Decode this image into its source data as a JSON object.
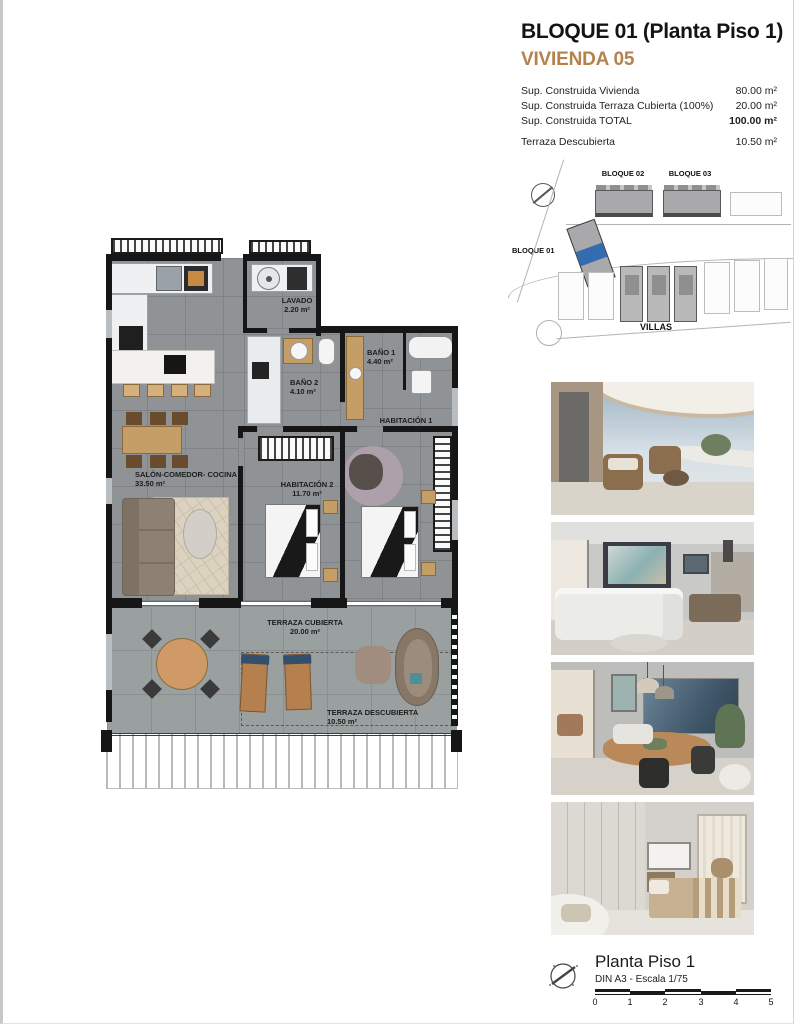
{
  "header": {
    "title": "BLOQUE 01  (Planta Piso 1)",
    "subtitle": "VIVIENDA 05",
    "areas": [
      {
        "label": "Sup. Construida Vivienda",
        "value": "80.00 m²"
      },
      {
        "label": "Sup. Construida Terraza Cubierta (100%)",
        "value": "20.00 m²"
      },
      {
        "label": "Sup. Construida TOTAL",
        "value": "100.00 m²"
      },
      {
        "label": "Terraza Descubierta",
        "value": "10.50 m²"
      }
    ]
  },
  "site_plan": {
    "bloque01": "BLOQUE 01",
    "bloque02": "BLOQUE 02",
    "bloque03": "BLOQUE 03",
    "villas": "VILLAS",
    "highlight_color": "#336db0"
  },
  "floor_plan": {
    "rooms": [
      {
        "name": "LAVADO",
        "area": "2.20 m²"
      },
      {
        "name": "BAÑO 2",
        "area": "4.10 m²"
      },
      {
        "name": "BAÑO 1",
        "area": "4.40 m²"
      },
      {
        "name": "HABITACIÓN 1",
        "area": "14.90 m²"
      },
      {
        "name": "HABITACIÓN 2",
        "area": "11.70 m²"
      },
      {
        "name": "SALÓN-COMEDOR- COCINA",
        "area": "33.50 m²"
      },
      {
        "name": "TERRAZA CUBIERTA",
        "area": "20.00 m²"
      },
      {
        "name": "TERRAZA DESCUBIERTA",
        "area": "10.50 m²"
      }
    ]
  },
  "footer": {
    "title": "Planta Piso 1",
    "scale_note": "DIN A3 - Escala 1/75",
    "ticks": [
      "0",
      "1",
      "2",
      "3",
      "4",
      "5"
    ]
  },
  "colors": {
    "accent": "#b5824e"
  }
}
